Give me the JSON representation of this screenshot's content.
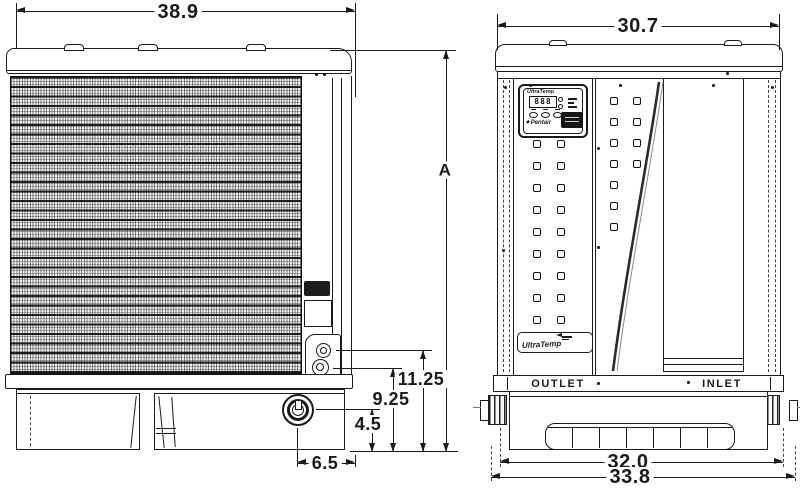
{
  "dims": {
    "side_width": "38.9",
    "front_width": "30.7",
    "overall_height": "A",
    "upper_connection_height": "11.25",
    "lower_connection_height": "9.25",
    "drain_height": "4.5",
    "drain_offset": "6.5",
    "base_width_inner": "32.0",
    "base_width_overall": "33.8"
  },
  "front": {
    "outlet_label": "OUTLET",
    "inlet_label": "INLET",
    "control_panel": {
      "brand": "UltraTemp",
      "display_value": "888",
      "maker": "Pentair"
    },
    "badge_brand": "UltraTemp"
  }
}
